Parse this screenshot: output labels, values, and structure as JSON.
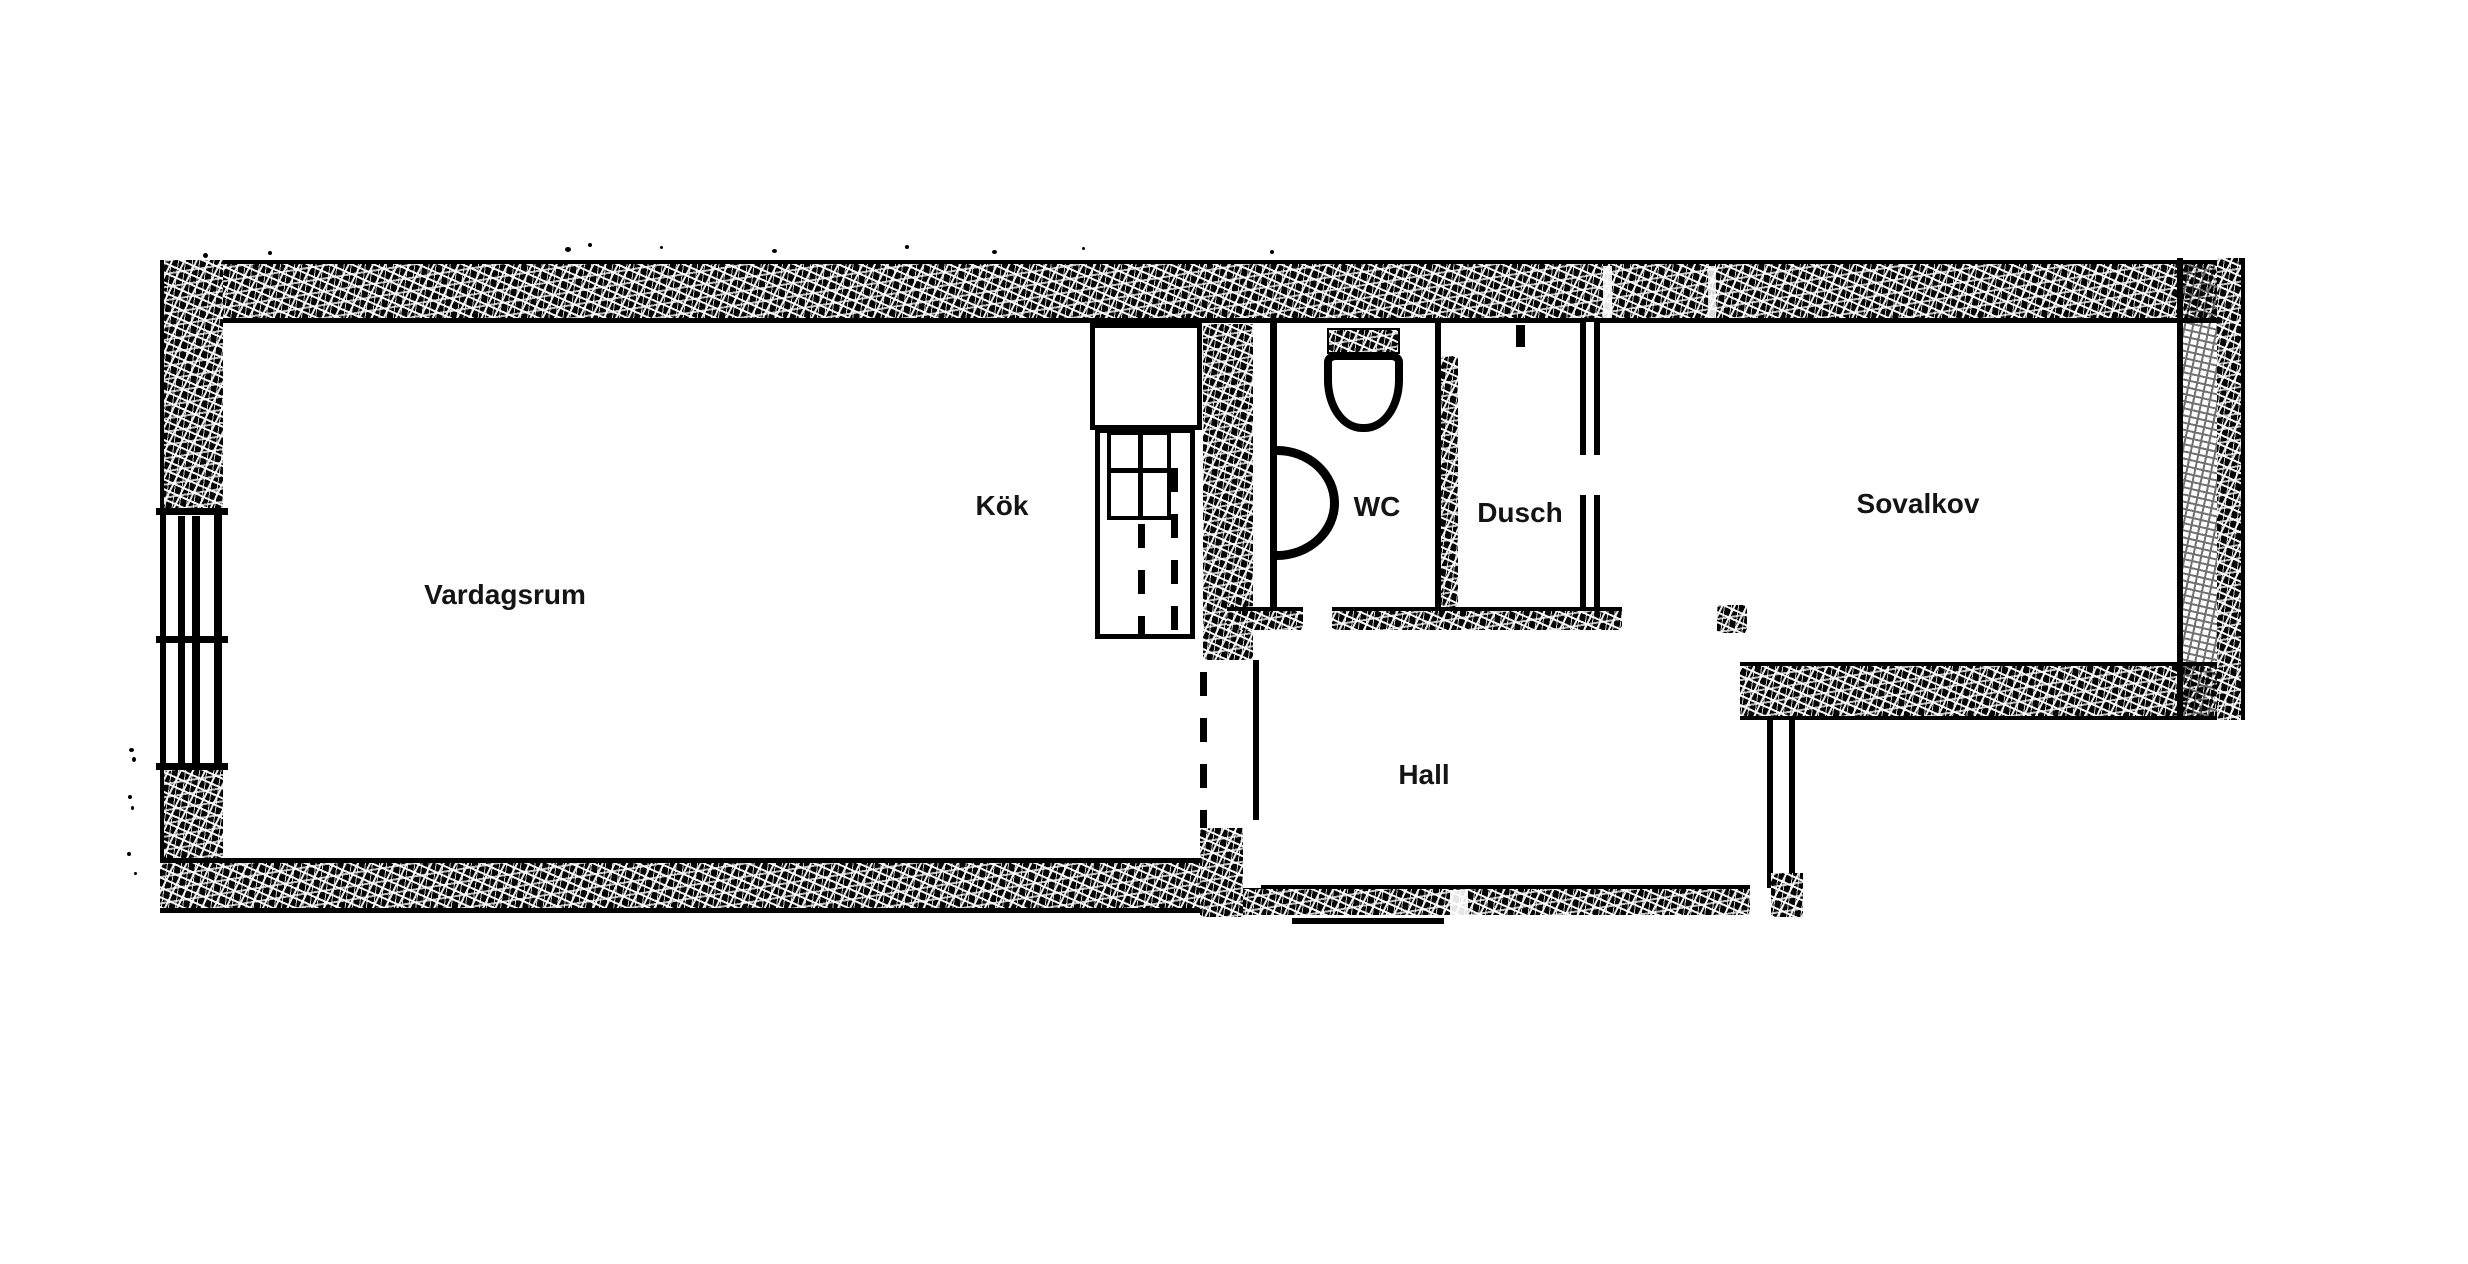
{
  "document": {
    "type": "floor-plan",
    "style": "scanned black-and-white architectural drawing"
  },
  "rooms": [
    {
      "id": "vardagsrum",
      "label": "Vardagsrum"
    },
    {
      "id": "kok",
      "label": "Kök"
    },
    {
      "id": "wc",
      "label": "WC"
    },
    {
      "id": "dusch",
      "label": "Dusch"
    },
    {
      "id": "sovalkov",
      "label": "Sovalkov"
    },
    {
      "id": "hall",
      "label": "Hall"
    }
  ],
  "icons": [
    {
      "id": "toilet",
      "name": "toilet-icon"
    },
    {
      "id": "basin",
      "name": "washbasin-icon"
    },
    {
      "id": "stove",
      "name": "stove-icon"
    },
    {
      "id": "window",
      "name": "window-icon"
    }
  ],
  "colors": {
    "ink": "#000000",
    "paper": "#ffffff",
    "label_ink": "#141414"
  }
}
